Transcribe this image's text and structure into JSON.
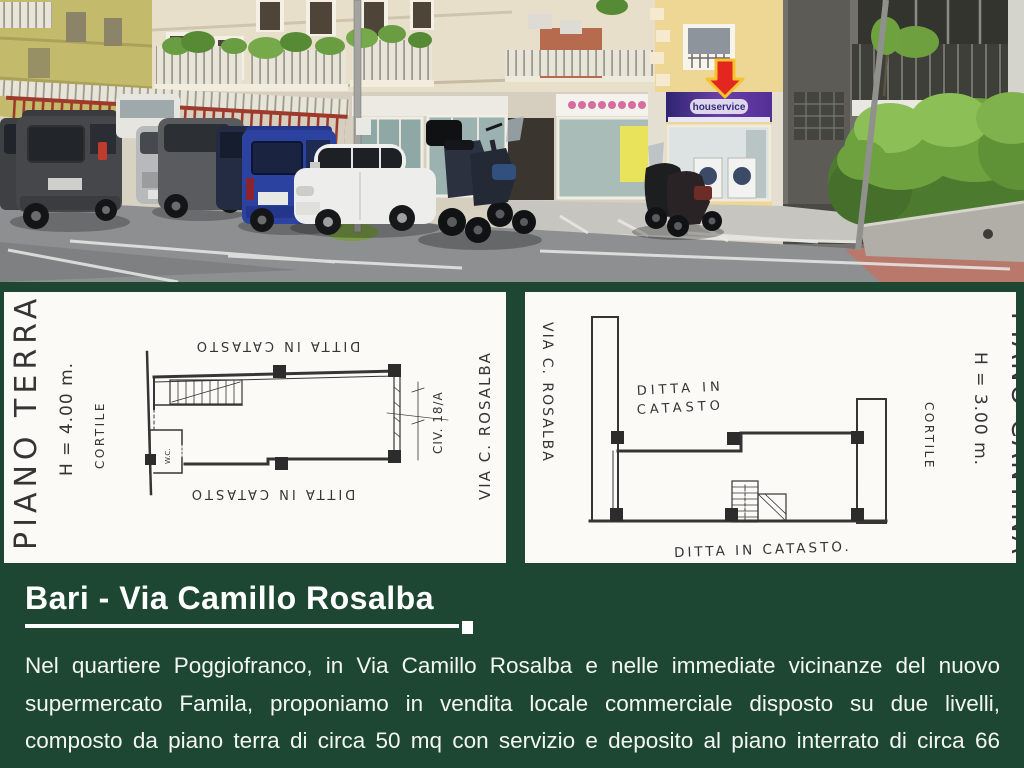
{
  "colors": {
    "background": "#1d4733",
    "panel": "#fbfaf6",
    "plan_ink": "#353535",
    "arrow_red": "#e3261f",
    "arrow_outline": "#f4c32f"
  },
  "photo": {
    "alt": "Street view of shops and apartment buildings with parked cars and motorcycles",
    "laundry_sign_text": "houservice"
  },
  "plan_left": {
    "title": "PIANO TERRA",
    "height_label": "H = 4.00 m.",
    "courtyard_label": "CORTILE",
    "ditta_top": "DITTA IN CATASTO",
    "ditta_bottom": "DITTA IN CATASTO",
    "wc_label": "W.C.",
    "civic_label": "CIV. 18/A",
    "street_label": "VIA C. ROSALBA"
  },
  "plan_right": {
    "street_label": "VIA  C. ROSALBA",
    "ditta_inner_line1": "DITTA IN",
    "ditta_inner_line2": "CATASTO",
    "courtyard_label": "CORTILE",
    "height_label": "H = 3.00 m.",
    "title": "PIANO CANTINA",
    "ditta_bottom": "DITTA IN CATASTO."
  },
  "caption": {
    "title": "Bari - Via Camillo Rosalba",
    "body_lines": [
      "Nel quartiere Poggiofranco, in Via Camillo Rosalba e nelle immediate vicinanze del nuovo",
      "supermercato Famila, proponiamo in vendita locale commerciale disposto su due livelli,",
      "composto da piano terra di circa 50 mq con servizio e deposito al piano interrato di circa 66",
      "mq . L’immobile si presenta in buono stato di conservazione, dotato di infissi esterni recenti,"
    ]
  }
}
